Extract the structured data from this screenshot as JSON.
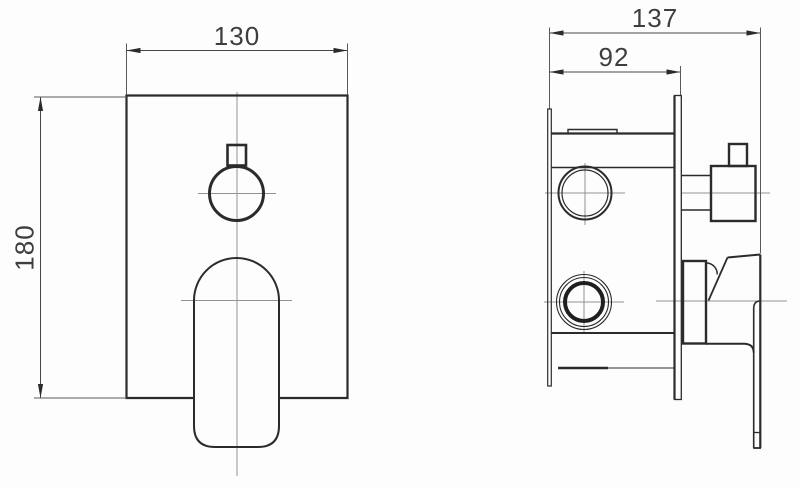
{
  "dimensions": {
    "front_width": {
      "label": "130"
    },
    "front_height": {
      "label": "180"
    },
    "side_total_depth": {
      "label": "137"
    },
    "side_body_depth": {
      "label": "92"
    }
  },
  "views": {
    "front": {
      "parts": [
        "escutcheon-plate",
        "diverter-knob",
        "mixer-handle"
      ]
    },
    "side": {
      "parts": [
        "mounting-bracket",
        "valve-body",
        "upper-port",
        "lower-port",
        "wall-plate",
        "diverter-knob",
        "lever-handle"
      ]
    }
  },
  "colors": {
    "outline": "#2b2b2b",
    "thin_line": "#5a5a5a",
    "centerline": "#929292",
    "dimension_line": "#474747",
    "text": "#3e3e3e",
    "background": "#fdfdfd"
  }
}
